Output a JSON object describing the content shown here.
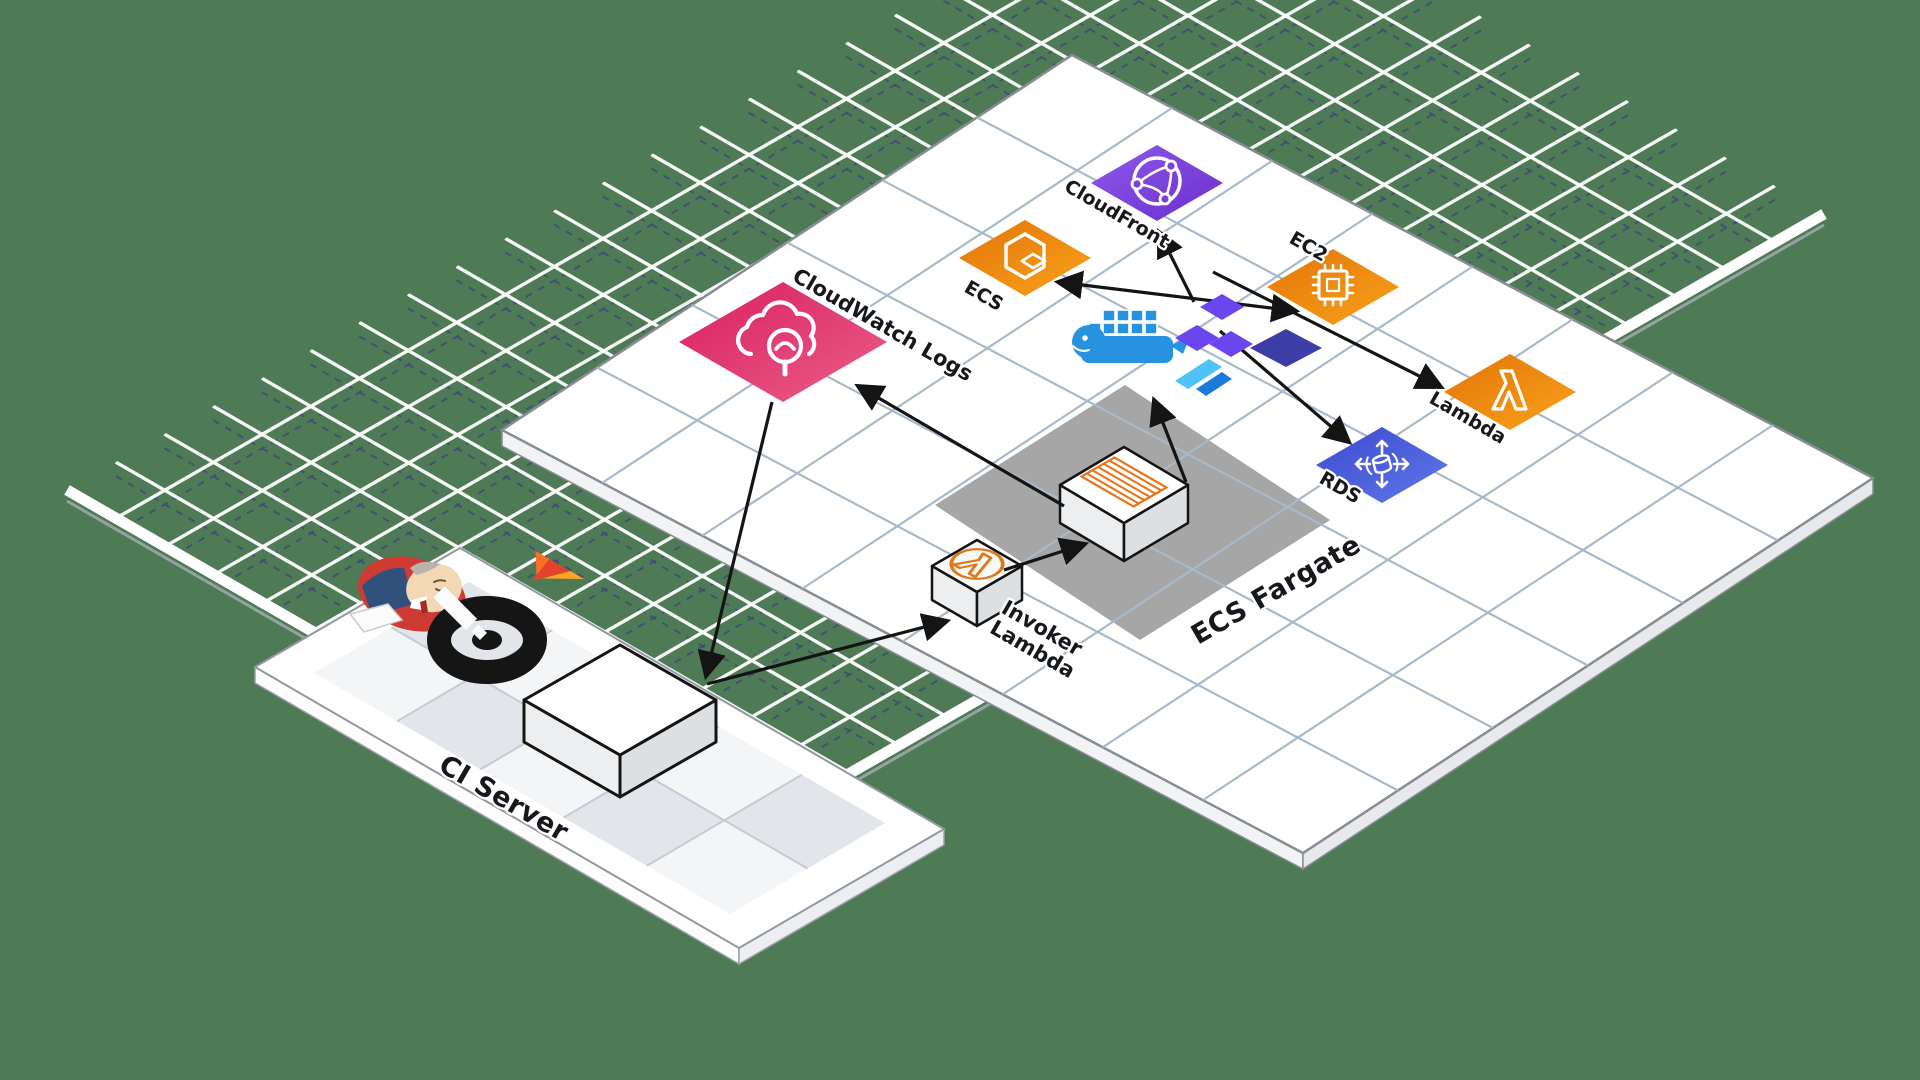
{
  "canvas": {
    "width": 1920,
    "height": 1080,
    "background": "#4E7A56"
  },
  "palette": {
    "floor_green": "#4E7A56",
    "grid_white": "#FFFFFF",
    "grid_navy_dashed": "#414B77",
    "platform_white": "#FFFFFF",
    "platform_grid": "#A8B9C9",
    "platform_edge": "#878D93",
    "ci_checker_gray": "#E2E6EA",
    "fargate_zone_gray": "#A6A6A6",
    "arrow_black": "#141414",
    "aws_orange_1": "#E27508",
    "aws_orange_2": "#F9A21B",
    "aws_purple_1": "#8F5AEA",
    "aws_purple_2": "#6B2ECF",
    "aws_pink_1": "#D91F60",
    "aws_pink_2": "#EA5E88",
    "aws_blue_1": "#3E49CE",
    "aws_blue_2": "#5E78EA",
    "docker_blue": "#2792E0",
    "terraform_purple": "#6B46EE",
    "terraform_dark": "#3D3DA8",
    "flutter_light": "#4FC3F8",
    "flutter_dark": "#1C7BD8",
    "gitlab_orange": "#FC6D26",
    "gitlab_red": "#E24329",
    "gitlab_amber": "#FDA326",
    "jenkins_red": "#CE3B33",
    "jenkins_suit": "#30517C",
    "jenkins_skin": "#F2D8B4",
    "lambda_cube_orange": "#E07818",
    "fargate_task_orange": "#E8751A"
  },
  "nodes": {
    "cloudfront": {
      "label": "CloudFront",
      "icon": "cloudfront-globe-icon"
    },
    "ecs": {
      "label": "ECS",
      "icon": "ecs-hexagon-icon"
    },
    "ec2": {
      "label": "EC2",
      "icon": "ec2-chip-icon"
    },
    "lambda": {
      "label": "Lambda",
      "icon": "lambda-icon"
    },
    "rds": {
      "label": "RDS",
      "icon": "rds-database-icon"
    },
    "cloudwatch_logs": {
      "label": "CloudWatch Logs",
      "icon": "cloudwatch-logs-icon"
    },
    "invoker_lambda": {
      "label_line1": "Invoker",
      "label_line2": "Lambda",
      "icon": "lambda-cube-icon"
    },
    "ecs_fargate": {
      "label": "ECS Fargate",
      "icon": "fargate-task-icon"
    },
    "ci_server": {
      "label": "CI Server",
      "icons": [
        "jenkins-icon",
        "gitlab-icon",
        "ci-ring-icon"
      ]
    }
  },
  "tool_icons": {
    "docker": "docker-whale-icon",
    "terraform": "terraform-blocks-icon",
    "flutter": "flutter-icon"
  },
  "connections": [
    {
      "from": "cloudwatch-logs",
      "to": "ci-server-box",
      "arrow_at": "ci-server-box"
    },
    {
      "from": "ci-server-box",
      "to": "invoker-lambda",
      "arrow_at": "invoker-lambda"
    },
    {
      "from": "invoker-lambda",
      "to": "ecs-fargate-box",
      "arrow_at": "ecs-fargate-box"
    },
    {
      "from": "ecs-fargate-box",
      "to": "cloudwatch-logs",
      "arrow_at": "cloudwatch-logs"
    },
    {
      "from": "ecs-fargate-box",
      "to": "docker-terraform-cluster",
      "arrow_at": "docker-terraform-cluster"
    },
    {
      "from": "terraform-hub",
      "to": "cloudfront",
      "arrow_at": "cloudfront"
    },
    {
      "from": "terraform-hub",
      "to": "ecs",
      "arrow_at": "ecs"
    },
    {
      "from": "terraform-hub",
      "to": "ec2",
      "arrow_at": "ec2"
    },
    {
      "from": "terraform-hub",
      "to": "lambda",
      "arrow_at": "lambda"
    },
    {
      "from": "terraform-hub",
      "to": "rds",
      "arrow_at": "rds"
    }
  ]
}
